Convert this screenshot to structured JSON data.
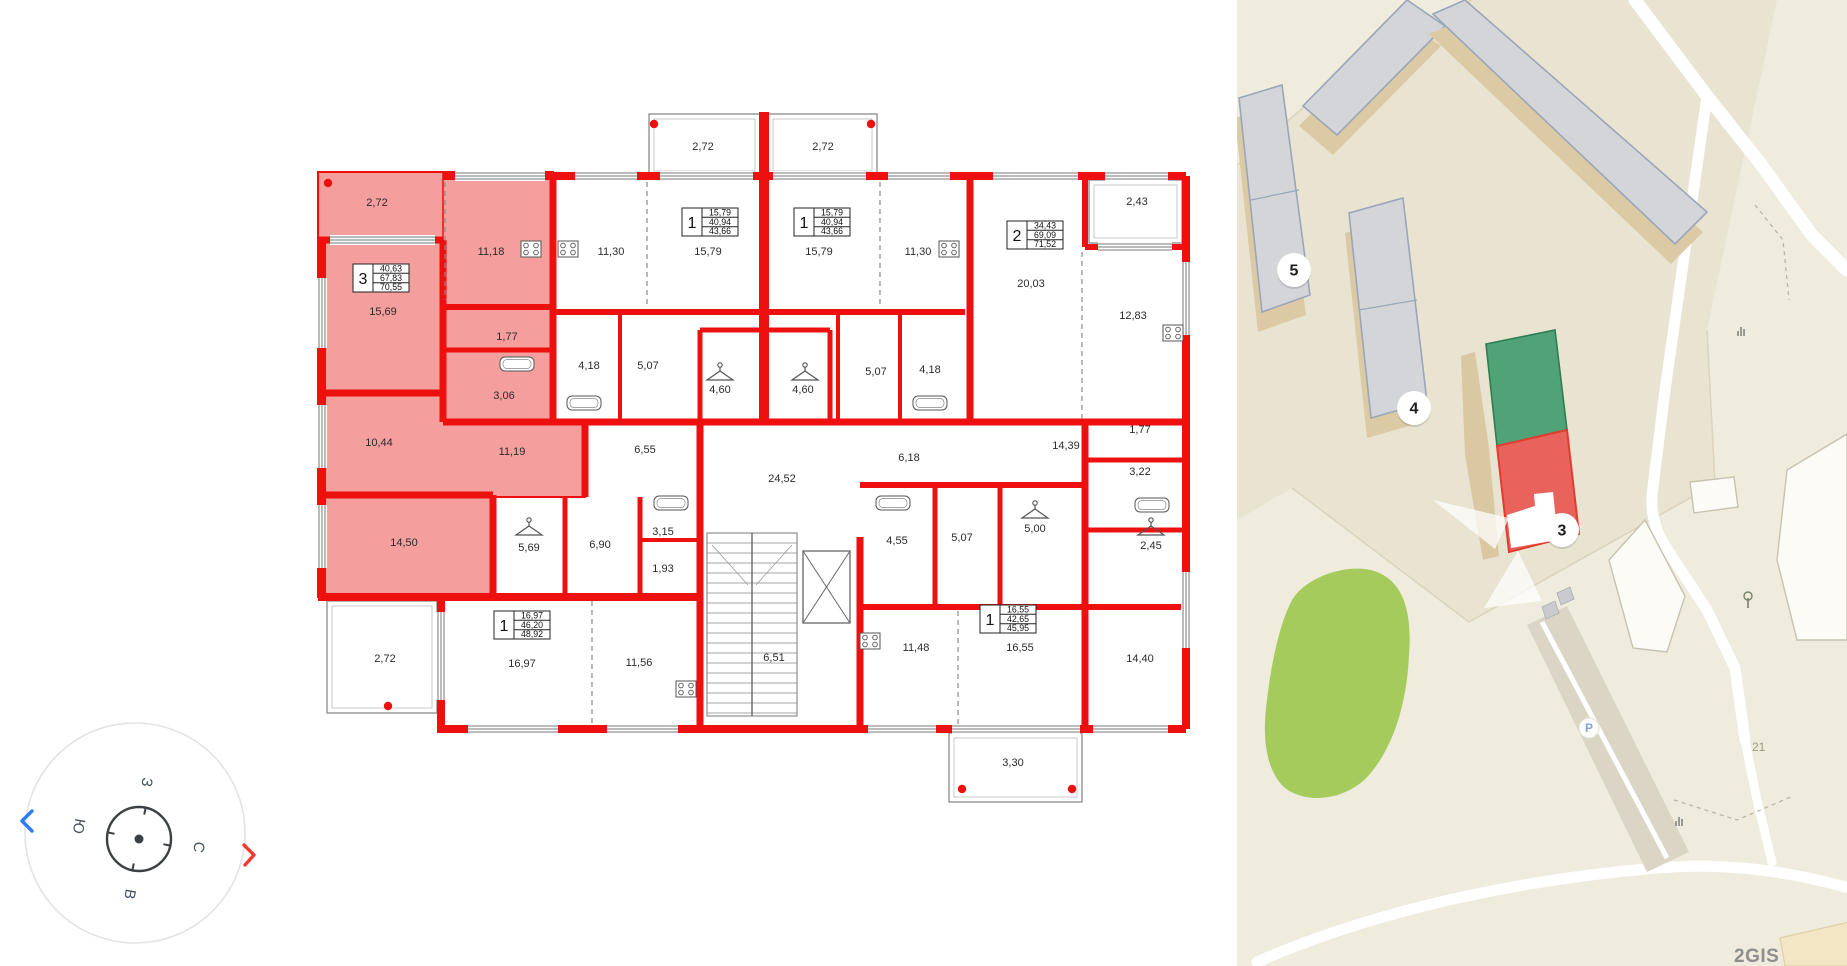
{
  "floor_plan": {
    "colors": {
      "wall": "#ee0f0f",
      "highlight": "#f59e9e",
      "lines": "#555555"
    },
    "apartments": [
      {
        "rooms": "3",
        "values": [
          "40,63",
          "67,83",
          "70,55"
        ],
        "x": 353,
        "y": 264,
        "highlighted": true
      },
      {
        "rooms": "1",
        "values": [
          "15,79",
          "40,94",
          "43,66"
        ],
        "x": 682,
        "y": 208,
        "highlighted": false
      },
      {
        "rooms": "1",
        "values": [
          "15,79",
          "40,94",
          "43,66"
        ],
        "x": 794,
        "y": 208,
        "highlighted": false
      },
      {
        "rooms": "2",
        "values": [
          "34,43",
          "69,09",
          "71,52"
        ],
        "x": 1007,
        "y": 221,
        "highlighted": false
      },
      {
        "rooms": "1",
        "values": [
          "16,97",
          "46,20",
          "48,92"
        ],
        "x": 494,
        "y": 611,
        "highlighted": false
      },
      {
        "rooms": "1",
        "values": [
          "16,55",
          "42,65",
          "45,95"
        ],
        "x": 980,
        "y": 605,
        "highlighted": false
      }
    ],
    "room_labels": [
      {
        "t": "2,72",
        "x": 377,
        "y": 203
      },
      {
        "t": "11,18",
        "x": 491,
        "y": 252
      },
      {
        "t": "15,69",
        "x": 383,
        "y": 312
      },
      {
        "t": "1,77",
        "x": 507,
        "y": 337
      },
      {
        "t": "3,06",
        "x": 504,
        "y": 396
      },
      {
        "t": "10,44",
        "x": 379,
        "y": 443
      },
      {
        "t": "11,19",
        "x": 512,
        "y": 452
      },
      {
        "t": "14,50",
        "x": 404,
        "y": 543
      },
      {
        "t": "2,72",
        "x": 703,
        "y": 147
      },
      {
        "t": "2,72",
        "x": 823,
        "y": 147
      },
      {
        "t": "11,30",
        "x": 611,
        "y": 252
      },
      {
        "t": "15,79",
        "x": 708,
        "y": 252
      },
      {
        "t": "15,79",
        "x": 819,
        "y": 252
      },
      {
        "t": "11,30",
        "x": 918,
        "y": 252
      },
      {
        "t": "4,18",
        "x": 589,
        "y": 366
      },
      {
        "t": "5,07",
        "x": 648,
        "y": 366
      },
      {
        "t": "4,60",
        "x": 720,
        "y": 390
      },
      {
        "t": "4,60",
        "x": 803,
        "y": 390
      },
      {
        "t": "5,07",
        "x": 876,
        "y": 372
      },
      {
        "t": "4,18",
        "x": 930,
        "y": 370
      },
      {
        "t": "2,43",
        "x": 1137,
        "y": 202
      },
      {
        "t": "20,03",
        "x": 1031,
        "y": 284
      },
      {
        "t": "12,83",
        "x": 1133,
        "y": 316
      },
      {
        "t": "6,55",
        "x": 645,
        "y": 450
      },
      {
        "t": "24,52",
        "x": 782,
        "y": 479
      },
      {
        "t": "6,18",
        "x": 909,
        "y": 458
      },
      {
        "t": "14,39",
        "x": 1066,
        "y": 446
      },
      {
        "t": "1,77",
        "x": 1140,
        "y": 430
      },
      {
        "t": "3,22",
        "x": 1140,
        "y": 472
      },
      {
        "t": "5,69",
        "x": 529,
        "y": 548
      },
      {
        "t": "6,90",
        "x": 600,
        "y": 545
      },
      {
        "t": "3,15",
        "x": 663,
        "y": 532
      },
      {
        "t": "1,93",
        "x": 663,
        "y": 569
      },
      {
        "t": "4,55",
        "x": 897,
        "y": 541
      },
      {
        "t": "5,07",
        "x": 962,
        "y": 538
      },
      {
        "t": "5,00",
        "x": 1035,
        "y": 529
      },
      {
        "t": "2,45",
        "x": 1151,
        "y": 546
      },
      {
        "t": "2,72",
        "x": 385,
        "y": 659
      },
      {
        "t": "16,97",
        "x": 522,
        "y": 664
      },
      {
        "t": "11,56",
        "x": 639,
        "y": 663
      },
      {
        "t": "6,51",
        "x": 774,
        "y": 658
      },
      {
        "t": "11,48",
        "x": 916,
        "y": 648
      },
      {
        "t": "16,55",
        "x": 1020,
        "y": 648
      },
      {
        "t": "14,40",
        "x": 1140,
        "y": 659
      },
      {
        "t": "3,30",
        "x": 1013,
        "y": 763
      }
    ]
  },
  "compass": {
    "top": "З",
    "left": "Ю",
    "right": "С",
    "bottom": "В"
  },
  "map": {
    "colors": {
      "selected_section": "#e8635b",
      "other_section": "#4fa377",
      "park": "#a6cb5d",
      "building": "#d4d5d9"
    },
    "markers": [
      {
        "label": "5",
        "x": 57,
        "y": 270
      },
      {
        "label": "4",
        "x": 177,
        "y": 408
      },
      {
        "label": "3",
        "x": 325,
        "y": 530
      }
    ],
    "parking": "P",
    "house_number": "21",
    "logo": "2GIS"
  }
}
